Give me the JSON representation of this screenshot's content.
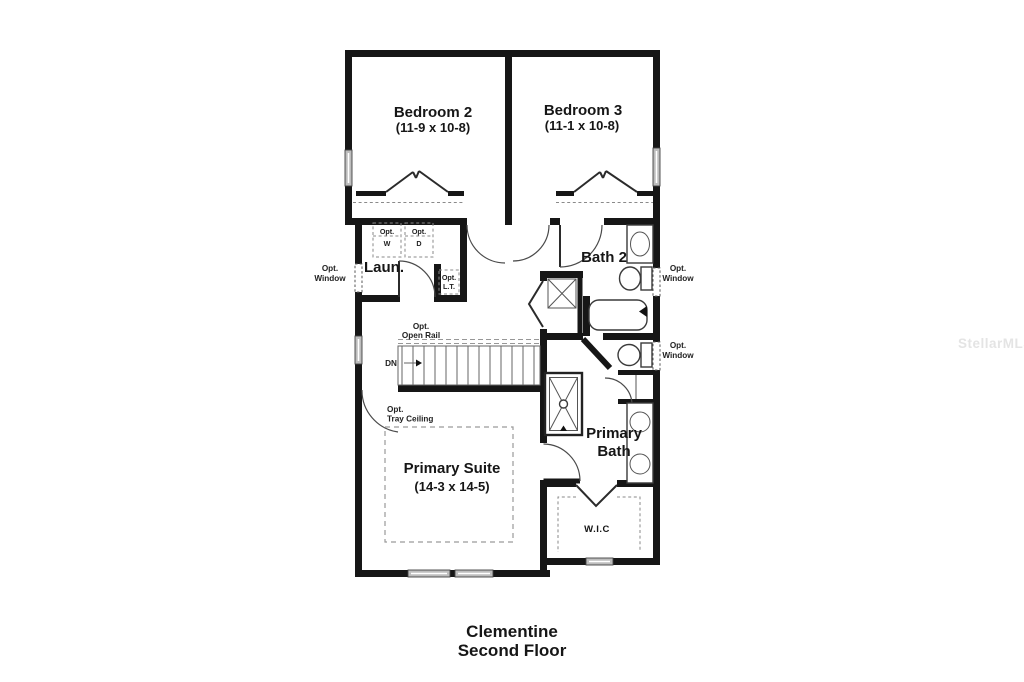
{
  "title": {
    "line1": "Clementine",
    "line2": "Second Floor"
  },
  "watermark": "StellarMLS",
  "rooms": {
    "bedroom2": {
      "name": "Bedroom 2",
      "dims": "(11-9 x 10-8)"
    },
    "bedroom3": {
      "name": "Bedroom 3",
      "dims": "(11-1 x 10-8)"
    },
    "bath2": {
      "name": "Bath 2"
    },
    "laundry": {
      "name": "Laun."
    },
    "primary_suite": {
      "name": "Primary Suite",
      "dims": "(14-3 x 14-5)"
    },
    "primary_bath": {
      "line1": "Primary",
      "line2": "Bath"
    },
    "wic": {
      "name": "W.I.C"
    }
  },
  "annotations": {
    "opt_washer": {
      "line1": "Opt.",
      "line2": "W"
    },
    "opt_dryer": {
      "line1": "Opt.",
      "line2": "D"
    },
    "opt_laundry_tub": {
      "line1": "Opt.",
      "line2": "L.T."
    },
    "opt_window": {
      "line1": "Opt.",
      "line2": "Window"
    },
    "opt_open_rail": {
      "line1": "Opt.",
      "line2": "Open Rail"
    },
    "opt_tray_ceiling": {
      "line1": "Opt.",
      "line2": "Tray Ceiling"
    },
    "stairs_down": "DN"
  },
  "colors": {
    "wall": "#161616",
    "fixture_line": "#3a3a3a",
    "dashed_line": "#8a8a8a",
    "window_fill": "#bdbdbd",
    "watermark": "#e4e4e4",
    "background": "#ffffff"
  }
}
